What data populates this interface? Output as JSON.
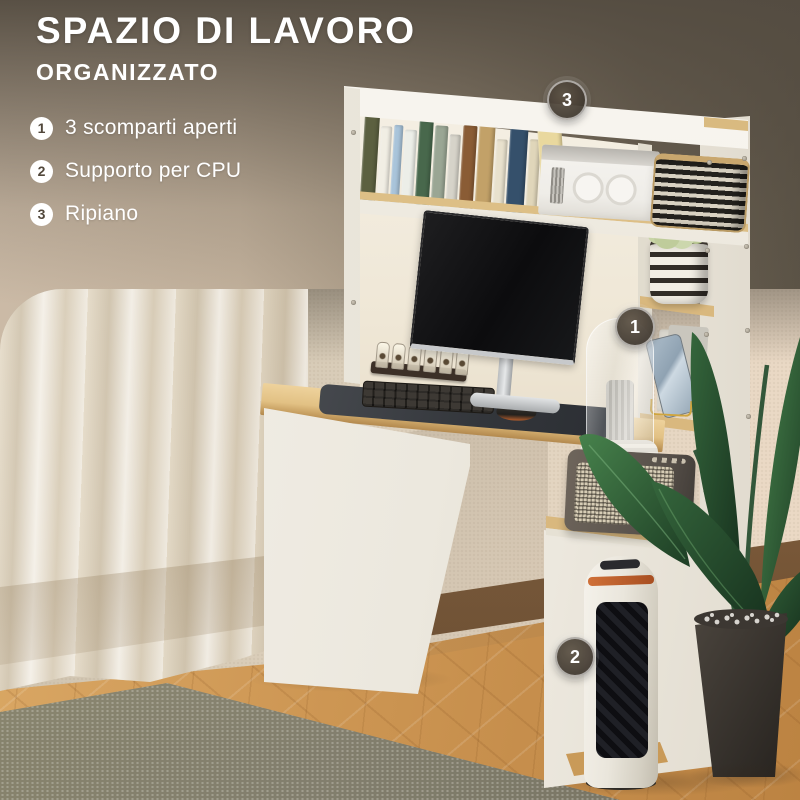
{
  "header": {
    "title": "SPAZIO DI LAVORO",
    "subtitle": "ORGANIZZATO"
  },
  "features": [
    {
      "num": "1",
      "label": "3 scomparti aperti"
    },
    {
      "num": "2",
      "label": "Supporto per CPU"
    },
    {
      "num": "3",
      "label": "Ripiano"
    }
  ],
  "markers": [
    {
      "num": "3",
      "x": 565,
      "y": 98
    },
    {
      "num": "1",
      "x": 633,
      "y": 325
    },
    {
      "num": "2",
      "x": 573,
      "y": 655
    }
  ],
  "colors": {
    "bg_dark": "#544c41",
    "bg_light": "#cbbaa6",
    "text": "#ffffff",
    "marker_fill": "#463e34",
    "marker_ring": "#ffffff",
    "badge_number": "#51473b",
    "wood_accent": "#ddbf86",
    "desk_wood": "#e2c184",
    "floor_wood": "#cd9653",
    "rug": "#8f8b79",
    "wall": "#e2d4c0",
    "leaf_green": "#2c5a33",
    "furniture_white": "#f3f0e9"
  },
  "books": {
    "spines": [
      {
        "w": 15,
        "h": 95,
        "color": "#5c6040",
        "deco": "bands"
      },
      {
        "w": 11,
        "h": 84,
        "color": "#f1eee4"
      },
      {
        "w": 10,
        "h": 86,
        "color": "#a9c4da"
      },
      {
        "w": 12,
        "h": 82,
        "color": "#eceee8"
      },
      {
        "w": 14,
        "h": 92,
        "color": "#48684c",
        "deco": "bands"
      },
      {
        "w": 13,
        "h": 88,
        "color": "#9aa694"
      },
      {
        "w": 11,
        "h": 80,
        "color": "#d6d3c9"
      },
      {
        "w": 15,
        "h": 90,
        "color": "#8a5c35",
        "deco": "bands"
      },
      {
        "w": 16,
        "h": 92,
        "color": "#c2a168",
        "deco": "bands"
      },
      {
        "w": 11,
        "h": 78,
        "color": "#e8e1cd"
      },
      {
        "w": 18,
        "h": 95,
        "color": "#35506b",
        "deco": "label"
      },
      {
        "w": 12,
        "h": 80,
        "color": "#e0d6ba"
      },
      {
        "w": 24,
        "h": 96,
        "color": "#e9d89e",
        "deco": "logo",
        "lean": true
      }
    ]
  }
}
